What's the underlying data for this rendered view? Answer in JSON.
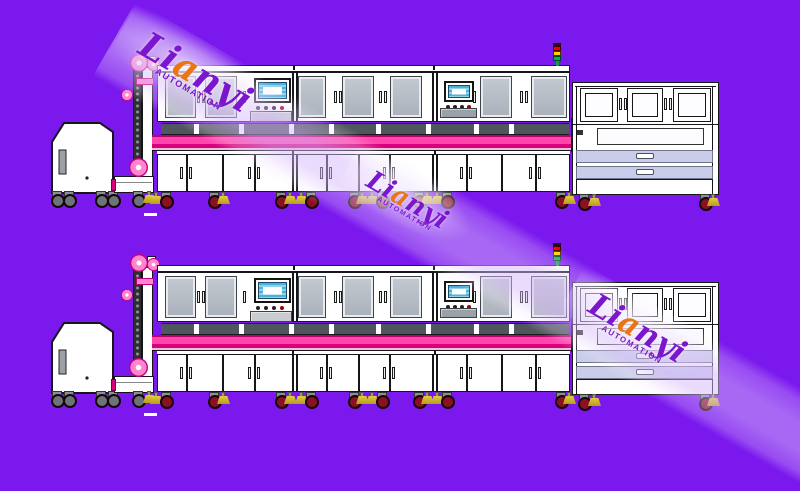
{
  "watermark": {
    "brand_pre": "Li",
    "brand_accent": "a",
    "brand_post": "nyi",
    "subtitle": "AUTOMATION"
  },
  "colors": {
    "bg": "#7A18EE",
    "outline": "#15151A",
    "machine-white": "#FFFFFF",
    "window-gray": "#AFB6BF",
    "window-border": "#3E444C",
    "recess-gray": "#50565E",
    "pink": "#FF46AC",
    "pink-deep": "#D8007C",
    "pink-edge": "#BC006C",
    "pink-light": "#F3BFDD",
    "elevator-pink": "#FF85CF",
    "elevator-ring": "#C2007E",
    "drawer-lavender": "#C9CDE9",
    "screen-blue": "#4FB0DC",
    "signal-red": "#EE0000",
    "signal-yellow": "#FFD400",
    "signal-green": "#00B44A",
    "caster-red": "#8C1022",
    "caster-gray": "#6E7377",
    "foot-yellow": "#E4CC3C",
    "wm-purple": "#7A16CE",
    "wm-accent": "#E87616",
    "band-tint": "rgba(214,184,250,0.5)"
  }
}
